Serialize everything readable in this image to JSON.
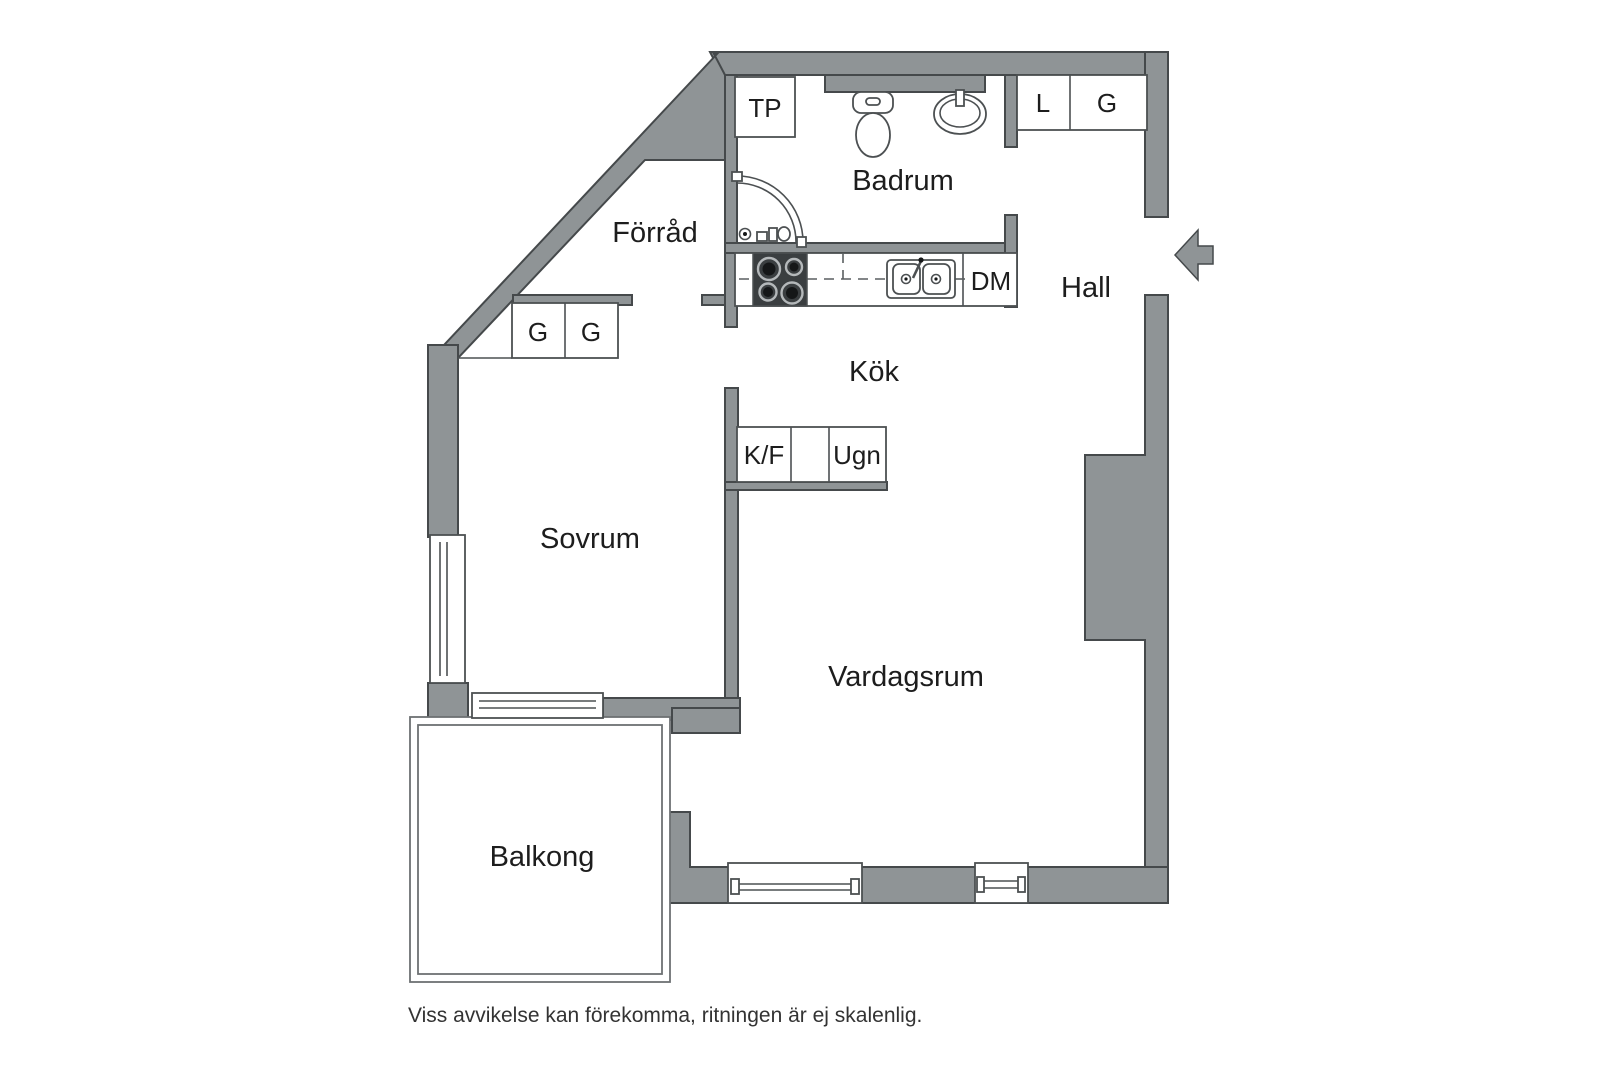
{
  "colors": {
    "wall_fill": "#8f9496",
    "wall_stroke": "#45494b",
    "fixture_stroke": "#4c5052",
    "balcony_stroke": "#6d7173",
    "dash_color": "#5a5f61",
    "stove_fill": "#3a3e40",
    "burner_ring": "#b4b8ba",
    "burner_dark": "#151718",
    "label_color": "#1d1d1d",
    "footer_color": "#333333"
  },
  "rooms": {
    "forrad": {
      "label": "Förråd"
    },
    "badrum": {
      "label": "Badrum"
    },
    "hall": {
      "label": "Hall"
    },
    "kok": {
      "label": "Kök"
    },
    "sovrum": {
      "label": "Sovrum"
    },
    "vardagsrum": {
      "label": "Vardagsrum"
    },
    "balkong": {
      "label": "Balkong"
    }
  },
  "appliances": {
    "tp": {
      "label": "TP"
    },
    "l_hall": {
      "label": "L"
    },
    "g_hall": {
      "label": "G"
    },
    "g_sovrum_1": {
      "label": "G"
    },
    "g_sovrum_2": {
      "label": "G"
    },
    "dm": {
      "label": "DM"
    },
    "kf": {
      "label": "K/F"
    },
    "ugn": {
      "label": "Ugn"
    }
  },
  "entrance": {
    "direction": "left"
  },
  "disclaimer": "Viss avvikelse kan förekomma, ritningen är ej skalenlig."
}
